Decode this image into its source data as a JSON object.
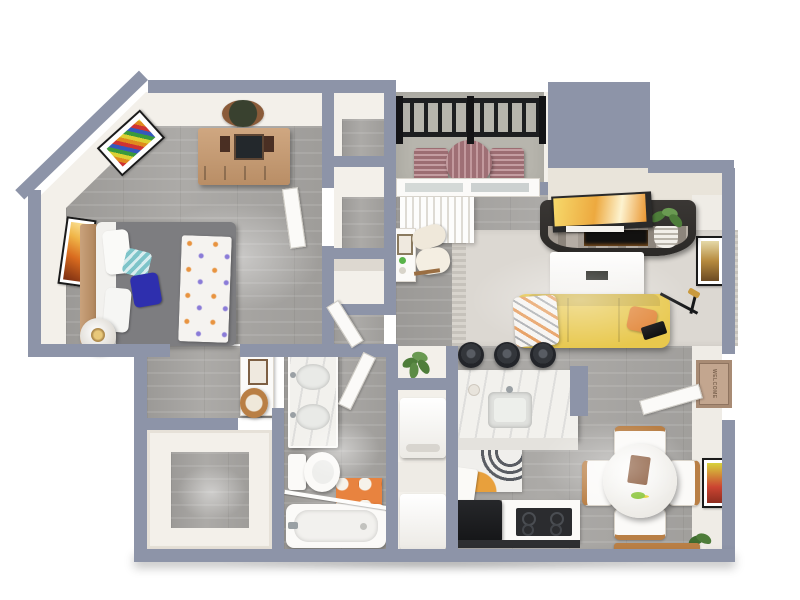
{
  "scene": {
    "kind": "3d-floor-plan-render",
    "view": "top-down",
    "background": "#ffffff",
    "rooms": [
      "bedroom",
      "closet-upper-a",
      "closet-upper-b",
      "shelf-nook",
      "balcony",
      "living-room",
      "kitchen",
      "laundry-closet",
      "dining-area",
      "bathroom",
      "hallway",
      "walk-in-closet",
      "entry"
    ]
  },
  "text": {
    "welcome_mat": "WELCOME"
  },
  "palette": {
    "wall": "#8d94a8",
    "interior": "#f3f0ea",
    "cream": "#e9e4da",
    "cream_light": "#efece6",
    "wood_floor": "#a7a5a2",
    "concrete": "#b7b5ad",
    "white": "#fbfaf8",
    "sofa_yellow": "#e8c84d",
    "pillow_orange": "#e2873a",
    "bed_gray": "#7d7d80",
    "blue": "#2e2fae",
    "teal": "#7ec4c9",
    "wood": "#c49d79",
    "wood_mid": "#b97f45",
    "wood_dark": "#8a5a3c",
    "mauve": "#b17c82",
    "dark": "#1d1e20",
    "charcoal": "#33363b",
    "marble": "#f2f1ed",
    "rug": "#dcd8d2",
    "rug_bath": "#e8833f",
    "mat": "#c3a68f",
    "plant": "#4e7d3a",
    "stone": "#9a928a"
  },
  "furniture": {
    "bedroom": [
      "bed",
      "headboard",
      "pillows",
      "blue-accent-pillow",
      "teal-pillow",
      "patterned-throw",
      "nightstand",
      "table-lamp",
      "dresser",
      "hanging-mirror",
      "rainbow-wall-art",
      "orange-wall-art"
    ],
    "balcony": [
      "metal-railing",
      "patio-chair",
      "patio-chair",
      "patio-table"
    ],
    "living_room": [
      "sliding-glass-door",
      "vertical-blinds",
      "media-console-fireplace",
      "tv-art",
      "book-stack",
      "basket-plant",
      "wall-art",
      "area-rug",
      "coffee-table",
      "remote",
      "yellow-sofa",
      "orange-throw-pillow",
      "knit-throw",
      "floor-lamp",
      "side-desk",
      "lounge-chair"
    ],
    "kitchen": [
      "island-counter",
      "bar-stool",
      "bar-stool",
      "bar-stool",
      "island-sink",
      "kitchen-rug",
      "refrigerator",
      "range-cooktop",
      "counter",
      "corner-sink"
    ],
    "laundry": [
      "washer",
      "dryer",
      "potted-plant"
    ],
    "dining": [
      "round-table",
      "dining-chair",
      "dining-chair",
      "dining-chair",
      "dining-chair",
      "wall-art",
      "floor-plant",
      "bench",
      "entry-door",
      "welcome-mat"
    ],
    "bathroom": [
      "double-sink-vanity",
      "toilet",
      "bathtub",
      "shower-rod",
      "accent-rug",
      "bathroom-door"
    ],
    "hallway": [
      "makeup-desk",
      "vanity-mirror",
      "desk-chair"
    ]
  }
}
